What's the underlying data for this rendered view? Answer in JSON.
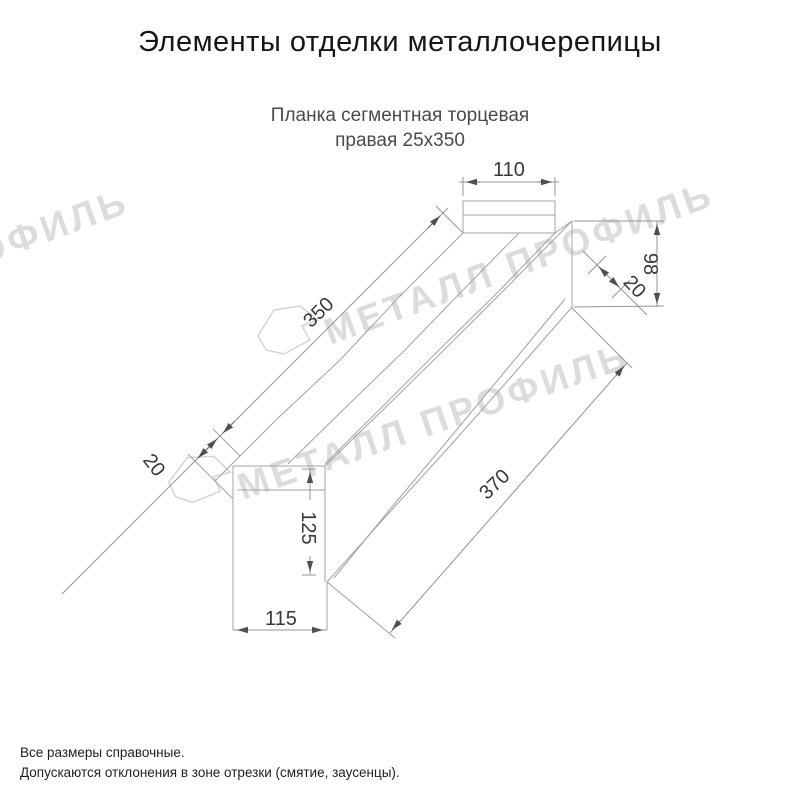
{
  "page": {
    "title": "Элементы отделки металлочерепицы",
    "subtitle_line1": "Планка сегментная торцевая",
    "subtitle_line2": "правая 25х350",
    "notes": [
      "Все размеры справочные.",
      "Допускаются отклонения в зоне отрезки (смятие, заусенцы)."
    ]
  },
  "watermark": {
    "text": "МЕТАЛЛ ПРОФИЛЬ",
    "color": "#dcdcdc",
    "logo": "metall-profil-pentagon"
  },
  "drawing": {
    "part_name": "Планка сегментная торцевая правая 25х350",
    "line_color": "#a3a3a3",
    "dimensions": {
      "top_width": "110",
      "length_top": "350",
      "left_flange": "20",
      "right_height": "98",
      "right_flange": "20",
      "left_height": "125",
      "length_bottom": "370",
      "bottom_width": "115"
    }
  }
}
